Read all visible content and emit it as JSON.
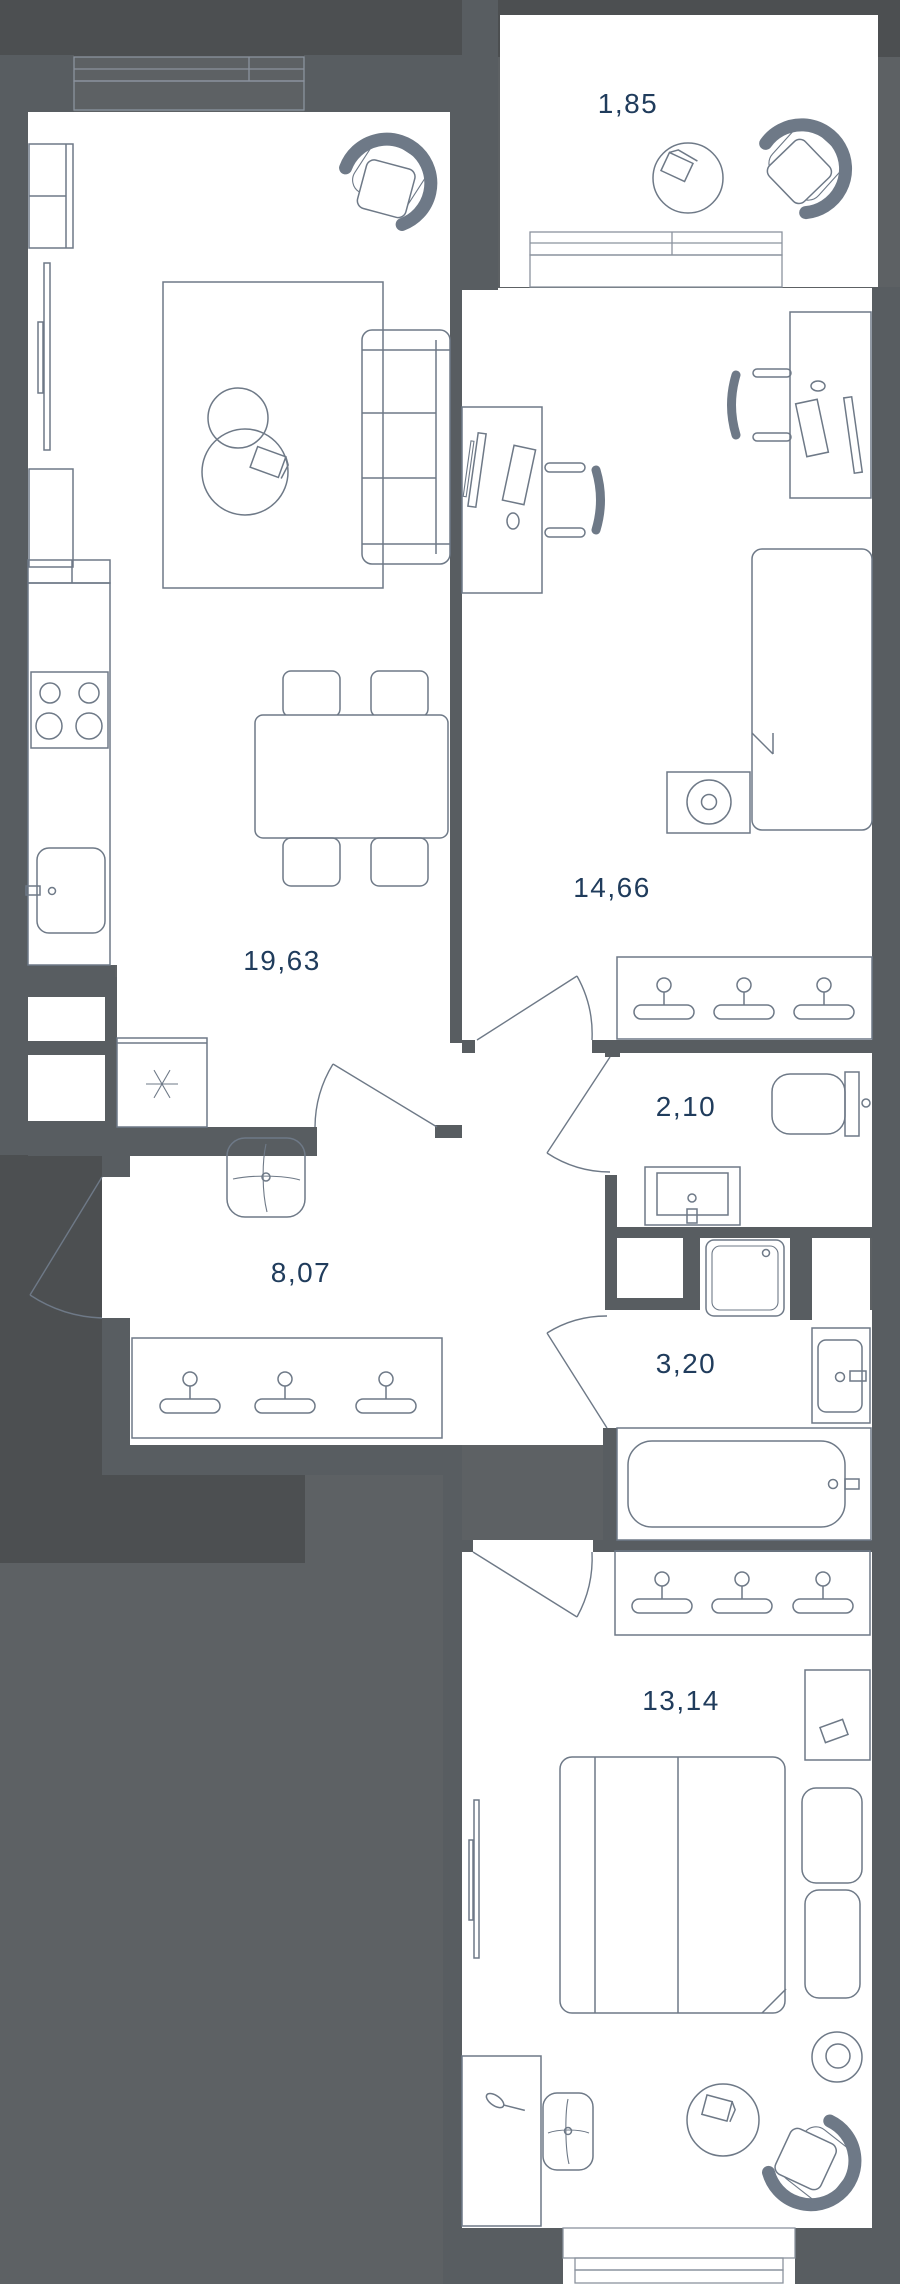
{
  "title": "Apartment floor plan",
  "rooms": [
    {
      "name": "loggia",
      "area_m2": "1,85"
    },
    {
      "name": "bedroom-1",
      "area_m2": "14,66"
    },
    {
      "name": "kitchen-living-room",
      "area_m2": "19,63"
    },
    {
      "name": "toilet",
      "area_m2": "2,10"
    },
    {
      "name": "hallway",
      "area_m2": "8,07"
    },
    {
      "name": "bathroom",
      "area_m2": "3,20"
    },
    {
      "name": "bedroom-2",
      "area_m2": "13,14"
    }
  ],
  "colors": {
    "background": "#5d6164",
    "outside_shadow": "#4c4f51",
    "walls": "#585d61",
    "room_fill": "#ffffff",
    "furniture_line": "#6e7987",
    "window_line": "#8b939e",
    "label_text": "#203c5c"
  }
}
